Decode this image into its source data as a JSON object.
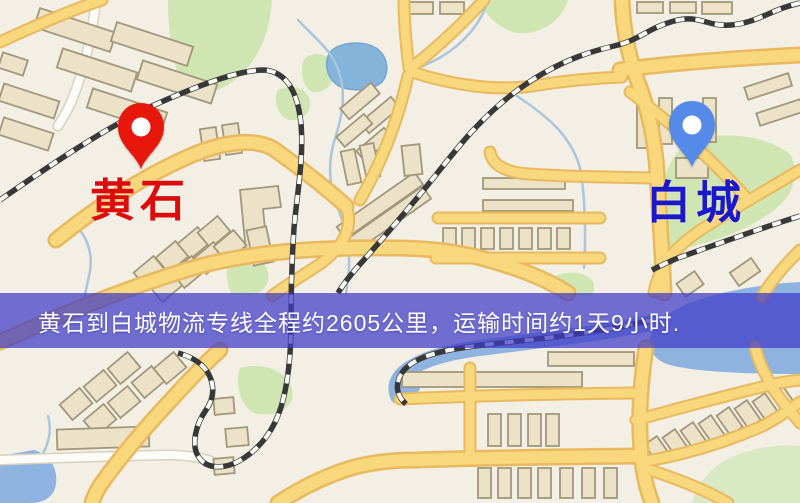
{
  "map": {
    "origin": {
      "name": "黄石",
      "pin_color": "#e8170b",
      "label_color": "#dc0c0c"
    },
    "destination": {
      "name": "白城",
      "pin_color": "#568ae8",
      "label_color": "#1b18cb"
    },
    "banner": {
      "text": "黄石到白城物流专线全程约2605公里，运输时间约1天9小时.",
      "background_color": "#3e3ac7",
      "text_color": "#ffffff"
    },
    "route": {
      "origin": "黄石",
      "destination": "白城",
      "service": "物流专线",
      "distance": "约2605公里",
      "duration": "约1天9小时"
    },
    "palette": {
      "map_background": "#f3efe4",
      "road": "#f8d77d",
      "road_casing": "#e9b95f",
      "building": "#ebe2c8",
      "green_area": "#cfe5b2",
      "water": "#8fb3e0",
      "railway": "#383838"
    }
  }
}
